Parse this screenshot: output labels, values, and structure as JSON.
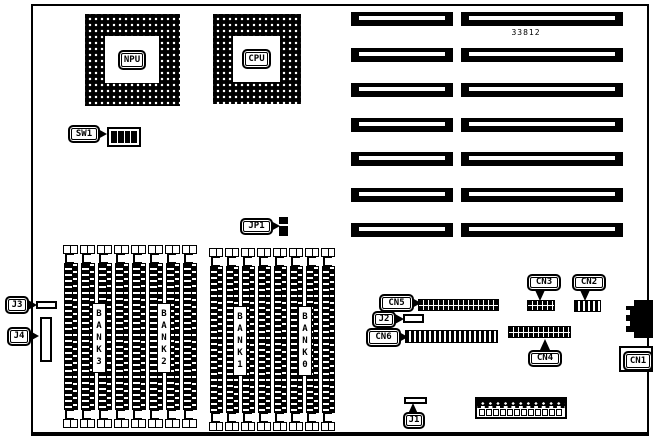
{
  "board": {
    "part_number": "33812",
    "npu_label": "NPU",
    "cpu_label": "CPU",
    "sw1_label": "SW1",
    "jp1_label": "JP1",
    "banks": {
      "bank3": "BANK3",
      "bank2": "BANK2",
      "bank1": "BANK1",
      "bank0": "BANK0"
    },
    "jumpers": {
      "j1": "J1",
      "j2": "J2",
      "j3": "J3",
      "j4": "J4"
    },
    "connectors": {
      "cn1": "CN1",
      "cn2": "CN2",
      "cn3": "CN3",
      "cn4": "CN4",
      "cn5": "CN5",
      "cn6": "CN6"
    },
    "layout_counts": {
      "expansion_slot_rows": 7,
      "simm_groups": 2,
      "simm_sockets_per_group": 8,
      "dip_switch_positions": 4,
      "power_connector_pins": 12
    }
  }
}
